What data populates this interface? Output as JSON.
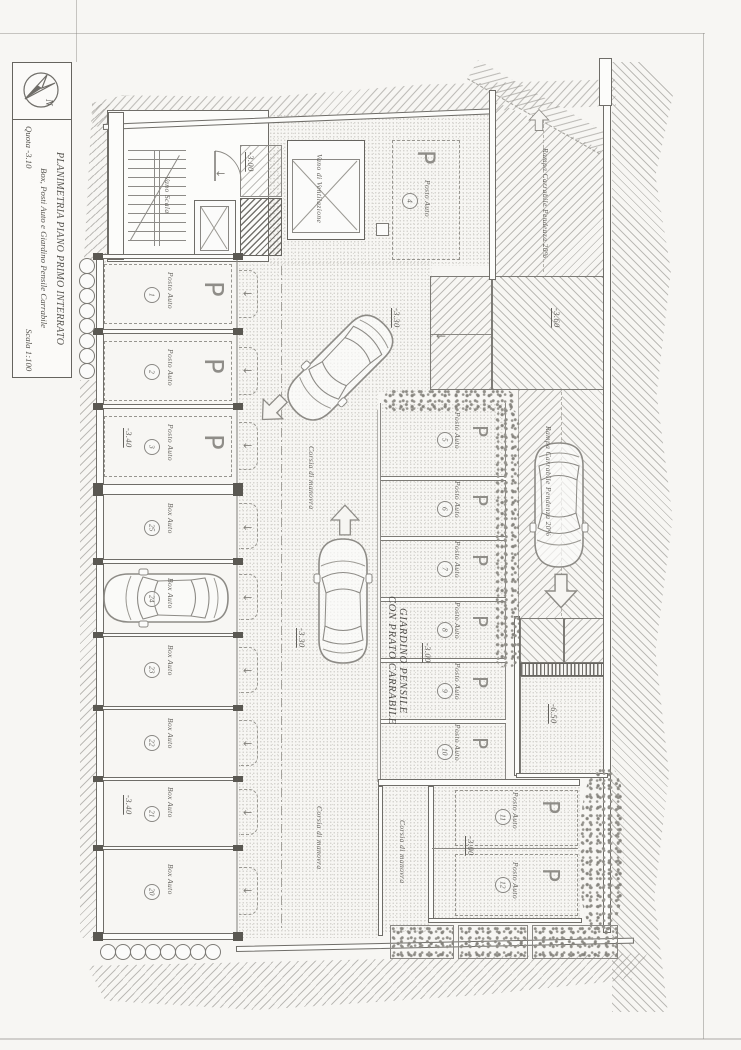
{
  "colors": {
    "ink": "#6f6d68",
    "paper": "#f7f6f3",
    "hatch": "#b7b5b0",
    "dark_fill": "#5a5852"
  },
  "title_block": {
    "north_letter": "N",
    "title": "PLANIMETRIA PIANO  PRIMO INTERRATO",
    "subtitle": "Box, Posti Auto e Giardino Pensile Carrabile",
    "quota_note": "Quota -3.10",
    "scale_note": "Scala 1:100"
  },
  "rooms": {
    "stair": "Vano Scala",
    "ventilation": "Vano di Ventilazione",
    "garden_line1": "GIARDINO PENSILE",
    "garden_line2": "CON PRATO CARRABILE"
  },
  "labels": {
    "corsia": "Corsia di manovra",
    "ramp": "Rampa Carrabile Pendenza 20%",
    "p": "P",
    "posto": "Posto Auto",
    "box": "Box Auto"
  },
  "quotas": {
    "stair": "-3.00",
    "corsia_upper": "-3.30",
    "corsia_lower": "-3.30",
    "ramp_turn": "-3.60",
    "garden": "-3.00",
    "bottom_spots": "-3.00",
    "pit": "-6.50"
  },
  "spot4": {
    "num": "4"
  },
  "left_column": [
    {
      "num": "1",
      "label": "Posto Auto",
      "quota": ""
    },
    {
      "num": "2",
      "label": "Posto Auto",
      "quota": ""
    },
    {
      "num": "3",
      "label": "Posto Auto",
      "quota": "-3.40"
    },
    {
      "num": "25",
      "label": "Box Auto",
      "quota": ""
    },
    {
      "num": "24",
      "label": "Box Auto",
      "quota": ""
    },
    {
      "num": "23",
      "label": "Box Auto",
      "quota": ""
    },
    {
      "num": "22",
      "label": "Box Auto",
      "quota": ""
    },
    {
      "num": "21",
      "label": "Box Auto",
      "quota": "-3.40"
    },
    {
      "num": "20",
      "label": "Box Auto",
      "quota": ""
    }
  ],
  "garden_spots": [
    {
      "num": "5"
    },
    {
      "num": "6"
    },
    {
      "num": "7"
    },
    {
      "num": "8"
    },
    {
      "num": "9"
    },
    {
      "num": "10"
    }
  ],
  "bottom_spots": [
    {
      "num": "11"
    },
    {
      "num": "12"
    }
  ]
}
